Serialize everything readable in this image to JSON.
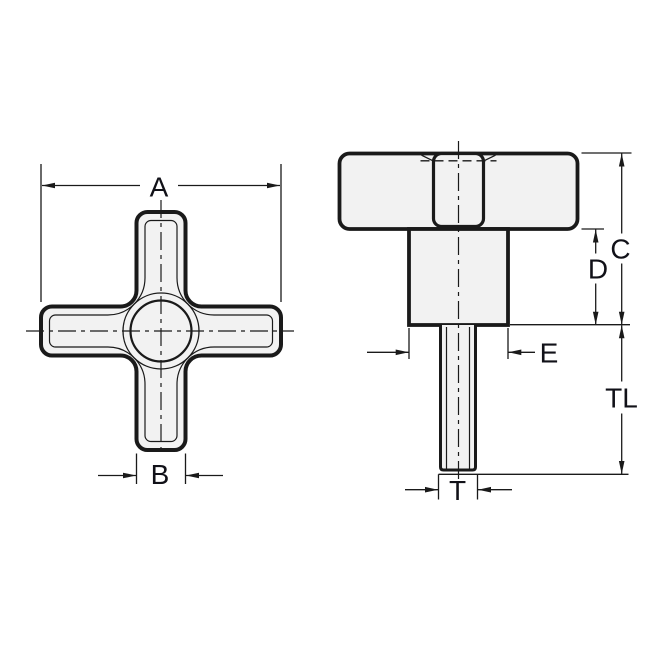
{
  "drawing": {
    "title": "Cross knob engineering drawing, front and side views",
    "views": [
      {
        "id": "front-view",
        "description": "cross / 4-arm knob face view",
        "dimension_ids": [
          "A",
          "B"
        ]
      },
      {
        "id": "side-view",
        "description": "knob side view with hub and threaded stud",
        "dimension_ids": [
          "C",
          "D",
          "E",
          "TL",
          "T"
        ]
      }
    ],
    "labels": {
      "a": "A",
      "b": "B",
      "c": "C",
      "d": "D",
      "e": "E",
      "tl": "TL",
      "t": "T"
    },
    "dimensions": [
      {
        "id": "A",
        "meaning": "overall knob width across arms"
      },
      {
        "id": "B",
        "meaning": "arm width"
      },
      {
        "id": "C",
        "meaning": "overall height head plus hub"
      },
      {
        "id": "D",
        "meaning": "hub height below head"
      },
      {
        "id": "E",
        "meaning": "hub diameter"
      },
      {
        "id": "TL",
        "meaning": "thread length"
      },
      {
        "id": "T",
        "meaning": "thread diameter"
      }
    ],
    "colors": {
      "line": "#1a1a1a",
      "part_fill": "#f2f2f2",
      "label_text": "#111118",
      "background": "#ffffff"
    }
  }
}
